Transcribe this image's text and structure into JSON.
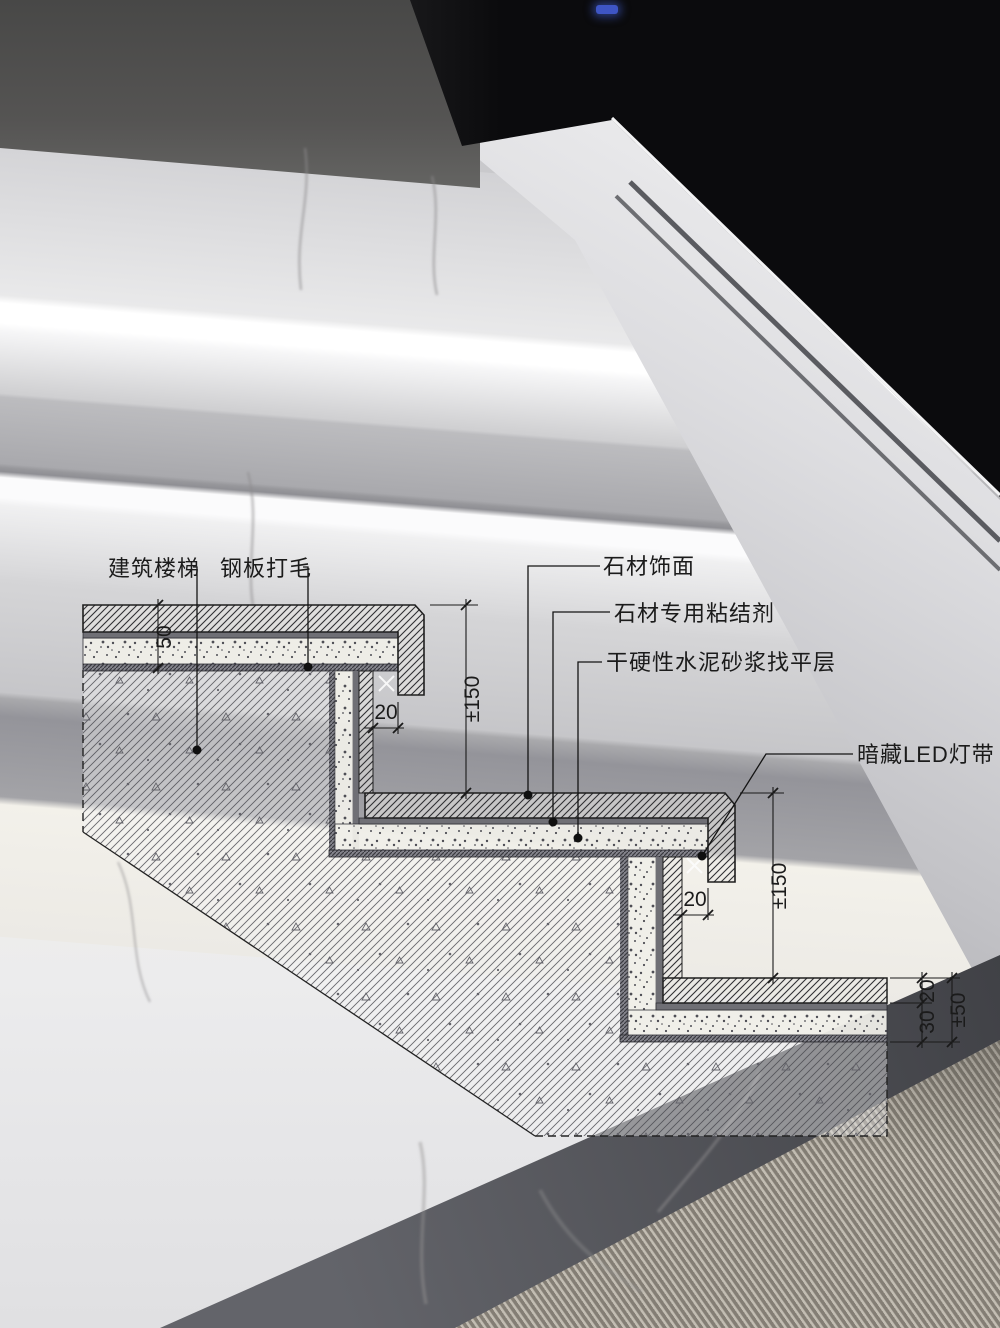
{
  "scene": {
    "description": "stone staircase photo with concealed LED strip lighting and construction detail drawing overlay"
  },
  "drawing": {
    "labels": {
      "building_stair": "建筑楼梯",
      "steel_plate": "钢板打毛",
      "stone_finish": "石材饰面",
      "stone_adhesive": "石材专用粘结剂",
      "mortar_leveling": "干硬性水泥砂浆找平层",
      "led_strip": "暗藏LED灯带"
    },
    "dimensions": {
      "tread_buildup": "50",
      "nosing_gap_step1": "20",
      "riser_height_step1": "±150",
      "nosing_gap_step2": "20",
      "riser_height_step2": "±150",
      "floor_stone": "20",
      "floor_bed": "30",
      "floor_total": "±50"
    },
    "colors": {
      "line": "#1b1b1b",
      "steel_band": "#84848c",
      "adhesive_band": "#6f6f75",
      "mortar_fill": "#efeee8",
      "led_accent": "#3e55c4"
    }
  }
}
